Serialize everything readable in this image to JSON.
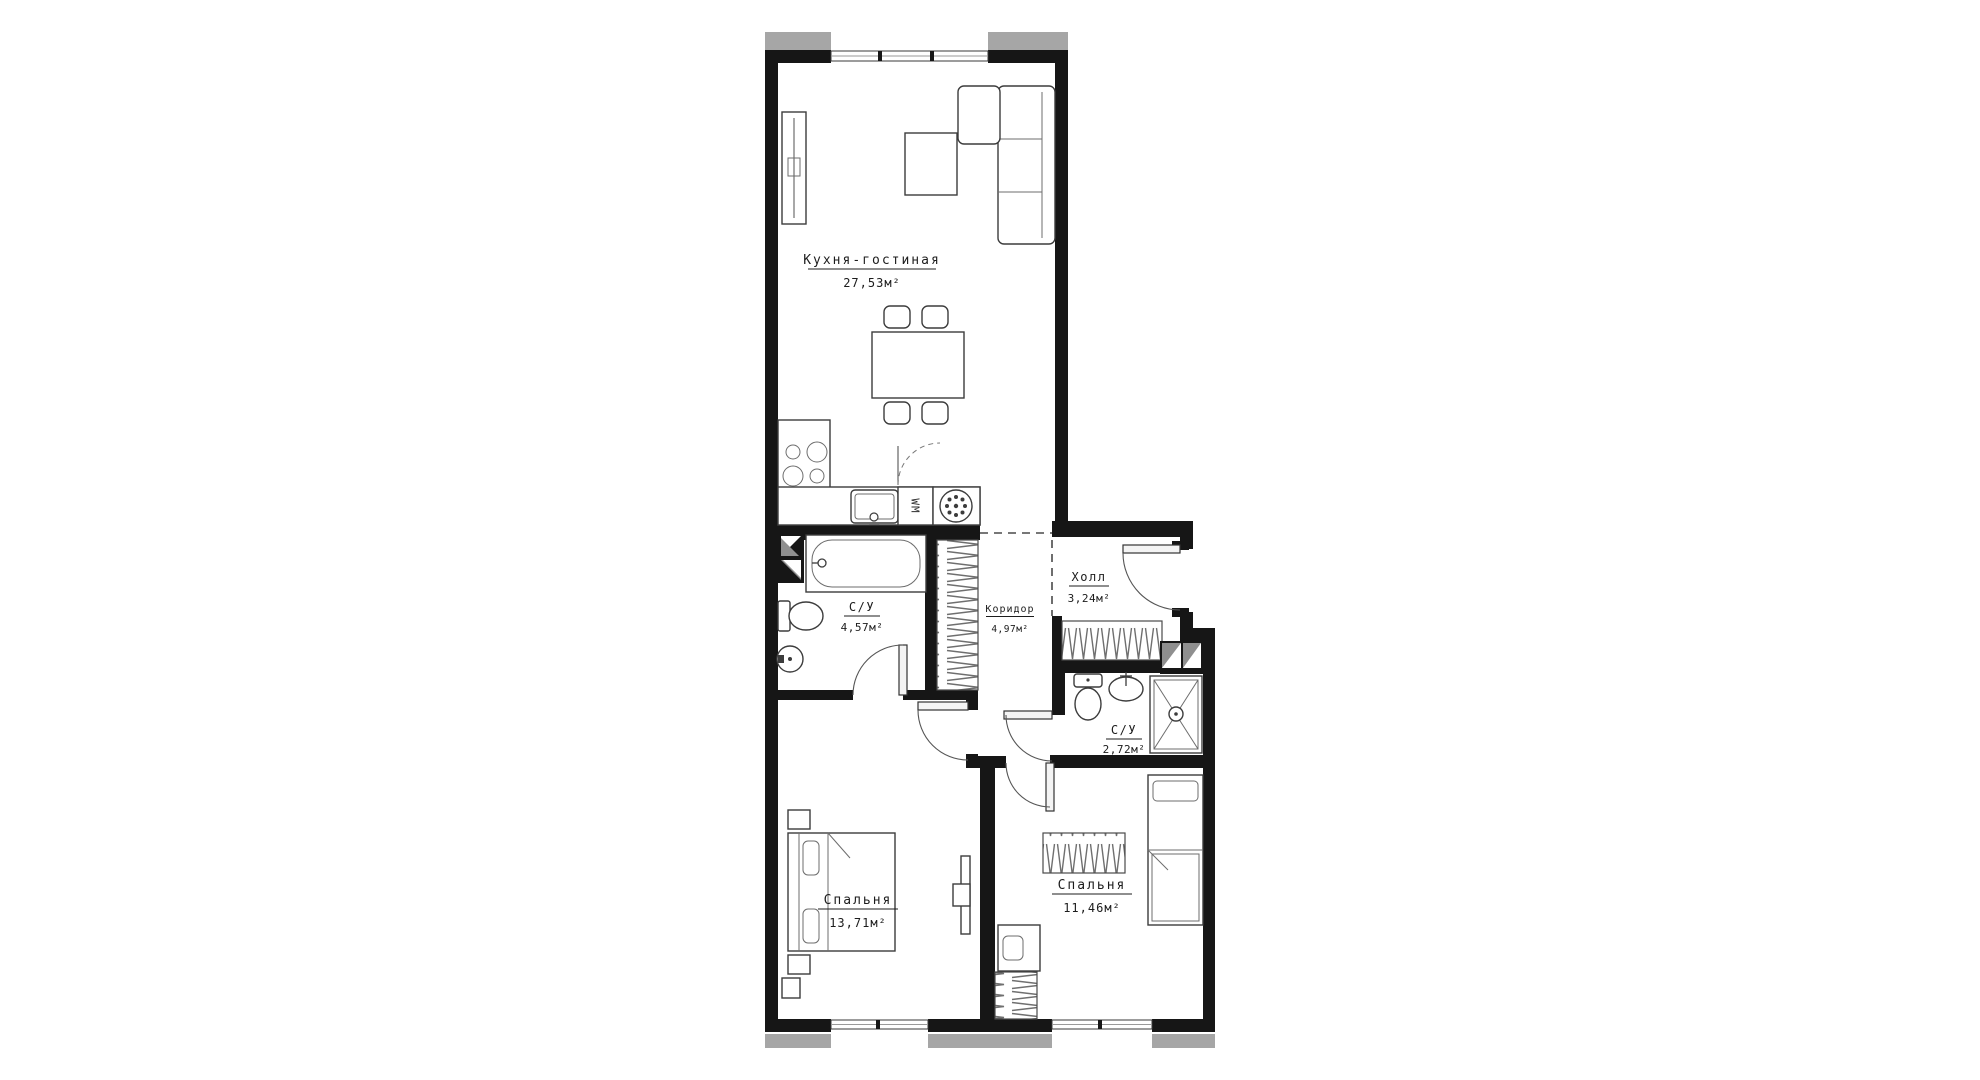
{
  "colors": {
    "wall": "#161616",
    "slab": "#a6a6a6",
    "text": "#1c1c1c"
  },
  "rooms": {
    "kitchen": {
      "name": "Кухня-гостиная",
      "area": "27,53м²"
    },
    "bathroom1": {
      "name": "С/У",
      "area": "4,57м²"
    },
    "corridor": {
      "name": "Коридор",
      "area": "4,97м²"
    },
    "hall": {
      "name": "Холл",
      "area": "3,24м²"
    },
    "bathroom2": {
      "name": "С/У",
      "area": "2,72м²"
    },
    "bedroom1": {
      "name": "Спальня",
      "area": "13,71м²"
    },
    "bedroom2": {
      "name": "Спальня",
      "area": "11,46м²"
    }
  },
  "labels": {
    "washing_machine": "WM"
  }
}
